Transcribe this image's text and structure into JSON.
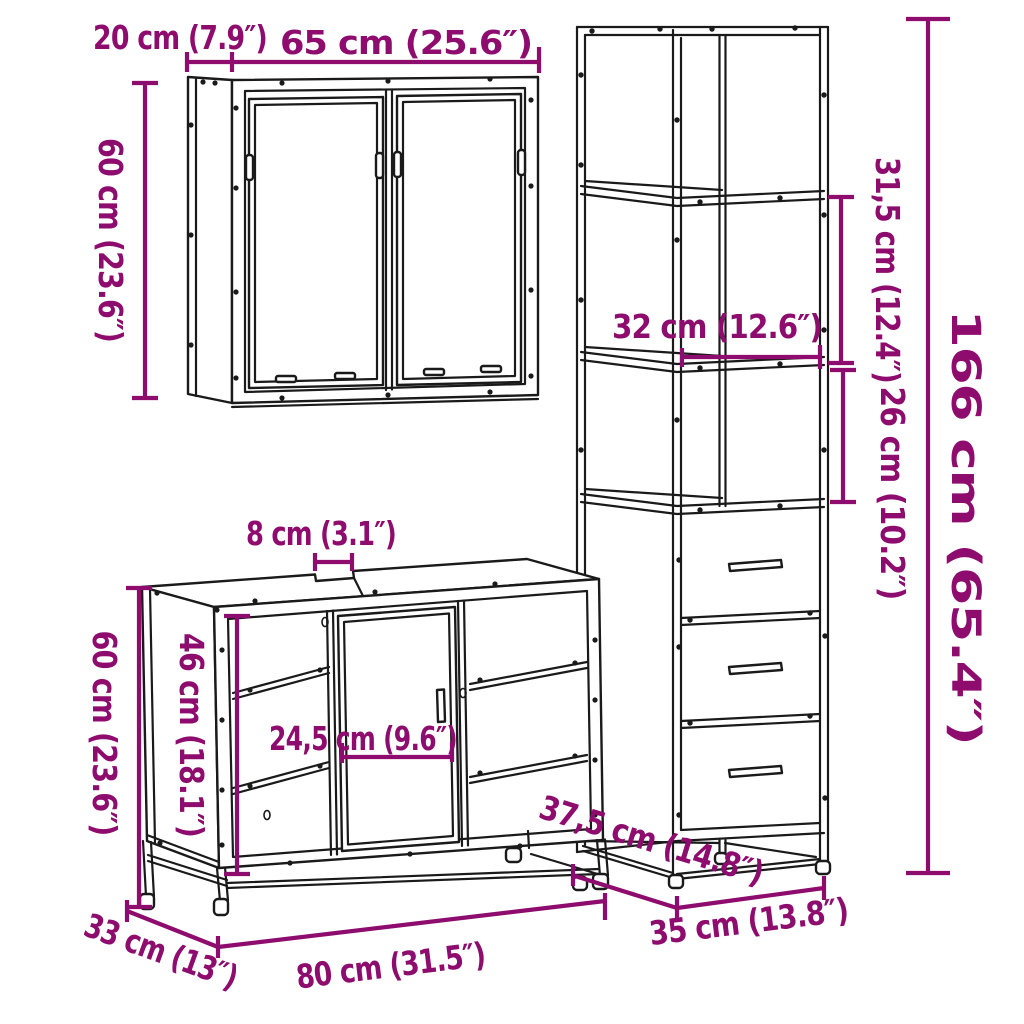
{
  "diagram": {
    "type": "furniture-dimension-diagram",
    "description": "3-piece bathroom furniture set line drawing with dimension annotations",
    "colors": {
      "dimension": "#8E0C6E",
      "line": "#1A1A1A",
      "background": "#FFFFFF"
    }
  },
  "pieces": {
    "mirror_cabinet": {
      "name": "wall mirror cabinet",
      "width": "65 cm (25.6″)",
      "depth": "20 cm (7.9″)",
      "height": "60 cm (23.6″)"
    },
    "tall_cabinet": {
      "name": "tall storage cabinet with drawers",
      "width": "35 cm (13.8″)",
      "depth": "37,5 cm (14.8″)",
      "height": "166 cm (65.4″)",
      "shelf_width": "32 cm (12.6″)",
      "upper_section_height": "31,5 cm (12.4″)",
      "lower_section_height": "26 cm (10.2″)"
    },
    "sink_cabinet": {
      "name": "sink vanity cabinet",
      "width": "80 cm (31.5″)",
      "depth": "33 cm (13″)",
      "height": "60 cm (23.6″)",
      "interior_height": "46 cm (18.1″)",
      "door_width": "24,5 cm (9.6″)",
      "top_gap": "8 cm (3.1″)"
    }
  }
}
